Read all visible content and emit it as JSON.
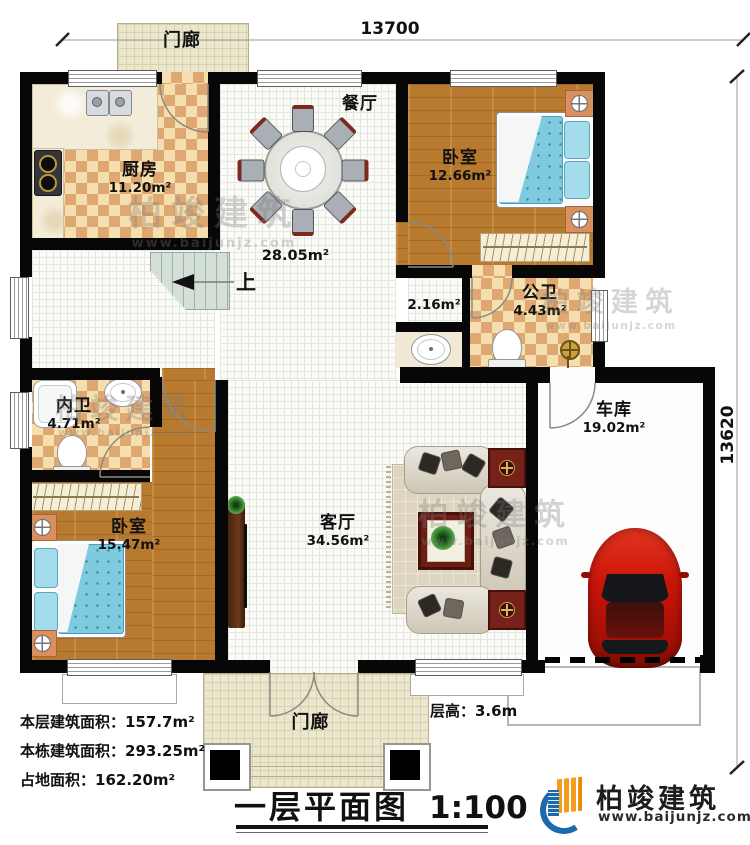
{
  "plan": {
    "rooms": {
      "porch_top": {
        "name": "门廊"
      },
      "kitchen": {
        "name": "厨房",
        "area": "11.20m²"
      },
      "dining": {
        "name": "餐厅",
        "area": "28.05m²"
      },
      "bedroom_top": {
        "name": "卧室",
        "area": "12.66m²"
      },
      "hall": {
        "area": "2.16m²"
      },
      "public_bath": {
        "name": "公卫",
        "area": "4.43m²"
      },
      "private_bath": {
        "name": "内卫",
        "area": "4.71m²"
      },
      "bedroom_left": {
        "name": "卧室",
        "area": "15.47m²"
      },
      "living": {
        "name": "客厅",
        "area": "34.56m²"
      },
      "garage": {
        "name": "车库",
        "area": "19.02m²"
      },
      "porch_bottom": {
        "name": "门廊"
      }
    },
    "stairs_up_label": "上",
    "dimensions": {
      "top": "13700",
      "right": "13620"
    },
    "floor_height": "层高：3.6m",
    "stats": [
      {
        "label": "本层建筑面积：",
        "value": "157.7m²"
      },
      {
        "label": "本栋建筑面积：",
        "value": "293.25m²"
      },
      {
        "label": "占地面积：",
        "value": "162.20m²"
      }
    ],
    "title": {
      "name": "一层平面图",
      "scale": "1:100"
    },
    "watermark": {
      "text": "柏竣建筑",
      "site": "www.baijunjz.com"
    },
    "brand": {
      "name": "柏竣建筑",
      "site": "www.baijunjz.com"
    },
    "colors": {
      "wall": "#070707",
      "checker_light": "#f6dfae",
      "checker_dark": "#dfa873",
      "wood": "#b87a2e",
      "car_red": "#cc1408",
      "brand_blue": "#1b6aad",
      "brand_orange": "#f59b1e"
    }
  }
}
